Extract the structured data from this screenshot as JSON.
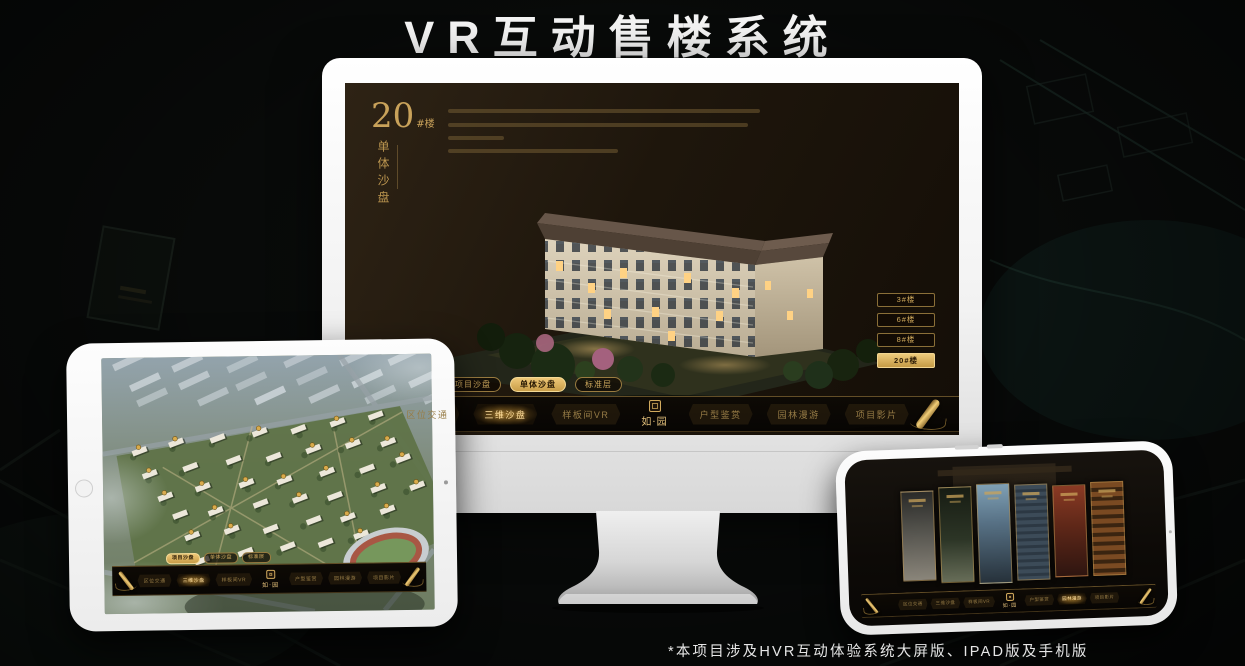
{
  "title": "VR互动售楼系统",
  "footnote": "*本项目涉及HVR互动体验系统大屏版、IPAD版及手机版",
  "brand": {
    "logo_text": "如·园",
    "gold": "#d2a85c",
    "gold_bright": "#f0c877",
    "screen_dark": "#1e160c"
  },
  "monitor": {
    "panel_title": {
      "number": "20",
      "suffix": "#楼",
      "subtitle_vertical": "单体沙盘"
    },
    "floor_buttons": [
      {
        "label": "3#楼",
        "active": false
      },
      {
        "label": "6#楼",
        "active": false
      },
      {
        "label": "8#楼",
        "active": false
      },
      {
        "label": "20#楼",
        "active": true
      }
    ],
    "subtabs": [
      {
        "label": "项目沙盘",
        "active": false
      },
      {
        "label": "单体沙盘",
        "active": true
      },
      {
        "label": "标准层",
        "active": false
      }
    ],
    "menu": {
      "scroll_left": false,
      "scroll_right": true,
      "items": [
        {
          "label": "区位交通"
        },
        {
          "label": "三维沙盘",
          "active": true
        },
        {
          "label": "样板间VR"
        },
        {
          "logo": "如·园"
        },
        {
          "label": "户型鉴赏"
        },
        {
          "label": "园林漫游"
        },
        {
          "label": "项目影片"
        }
      ]
    }
  },
  "tablet": {
    "subtabs": [
      {
        "label": "项目沙盘",
        "active": true
      },
      {
        "label": "单体沙盘",
        "active": false
      },
      {
        "label": "标准层",
        "active": false
      }
    ],
    "menu": {
      "scroll_left": true,
      "scroll_right": true,
      "items": [
        {
          "label": "区位交通"
        },
        {
          "label": "三维沙盘",
          "active": true
        },
        {
          "label": "样板间VR"
        },
        {
          "logo": "如·园"
        },
        {
          "label": "户型鉴赏"
        },
        {
          "label": "园林漫游"
        },
        {
          "label": "项目影片"
        }
      ]
    }
  },
  "phone": {
    "menu": {
      "scroll_left": true,
      "scroll_right": true,
      "items": [
        {
          "label": "区位交通"
        },
        {
          "label": "三维沙盘"
        },
        {
          "label": "样板间VR"
        },
        {
          "logo": "如·园"
        },
        {
          "label": "户型鉴赏"
        },
        {
          "label": "园林漫游",
          "active": true
        },
        {
          "label": "项目影片"
        }
      ]
    }
  }
}
